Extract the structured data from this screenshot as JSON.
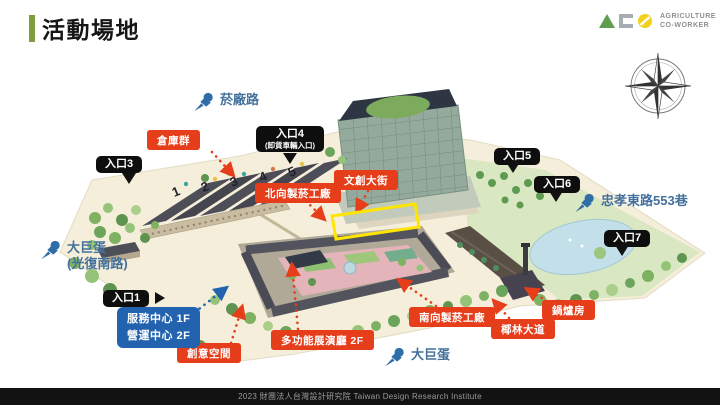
{
  "title": "活動場地",
  "footer": "2023 財團法人台灣設計研究院 Taiwan Design Research Institute",
  "logo": {
    "brand_line1": "AGRICULTURE",
    "brand_line2": "CO-WORKER"
  },
  "map": {
    "warehouse_numbers": [
      "1",
      "2",
      "3",
      "4",
      "5"
    ],
    "roads": [
      {
        "id": "yanchang-road",
        "label": "菸廠路"
      },
      {
        "id": "taipei-dome-guangfu",
        "label": "大巨蛋",
        "sub": "(光復南路)"
      },
      {
        "id": "zhongxiao-east-553",
        "label": "忠孝東路553巷"
      },
      {
        "id": "taipei-dome",
        "label": "大巨蛋"
      }
    ],
    "entrances": [
      {
        "id": "entrance-1",
        "label": "入口1"
      },
      {
        "id": "entrance-3",
        "label": "入口3"
      },
      {
        "id": "entrance-4",
        "label": "入口4",
        "sub": "(卸貨車輛入口)"
      },
      {
        "id": "entrance-5",
        "label": "入口5"
      },
      {
        "id": "entrance-6",
        "label": "入口6"
      },
      {
        "id": "entrance-7",
        "label": "入口7"
      }
    ],
    "venues": [
      {
        "id": "warehouse-cluster",
        "label": "倉庫群"
      },
      {
        "id": "north-tobacco-factory",
        "label": "北向製菸工廠"
      },
      {
        "id": "creative-street",
        "label": "文創大街"
      },
      {
        "id": "creative-space",
        "label": "創意空間"
      },
      {
        "id": "multifunction-hall",
        "label": "多功能展演廳 2F"
      },
      {
        "id": "south-tobacco-factory",
        "label": "南向製菸工廠"
      },
      {
        "id": "palm-avenue",
        "label": "椰林大道"
      },
      {
        "id": "boiler-room",
        "label": "鍋爐房"
      }
    ],
    "service_center": {
      "line1": "服務中心 1F",
      "line2": "營運中心 2F"
    }
  },
  "colors": {
    "accent_green": "#7f9c3f",
    "label_red": "#e63d1a",
    "label_blue": "#2262ae",
    "label_black": "#0e0e0e",
    "pin_blue": "#2f6da9",
    "highlight_yellow": "#ffe600",
    "footer_bg": "#121212"
  }
}
